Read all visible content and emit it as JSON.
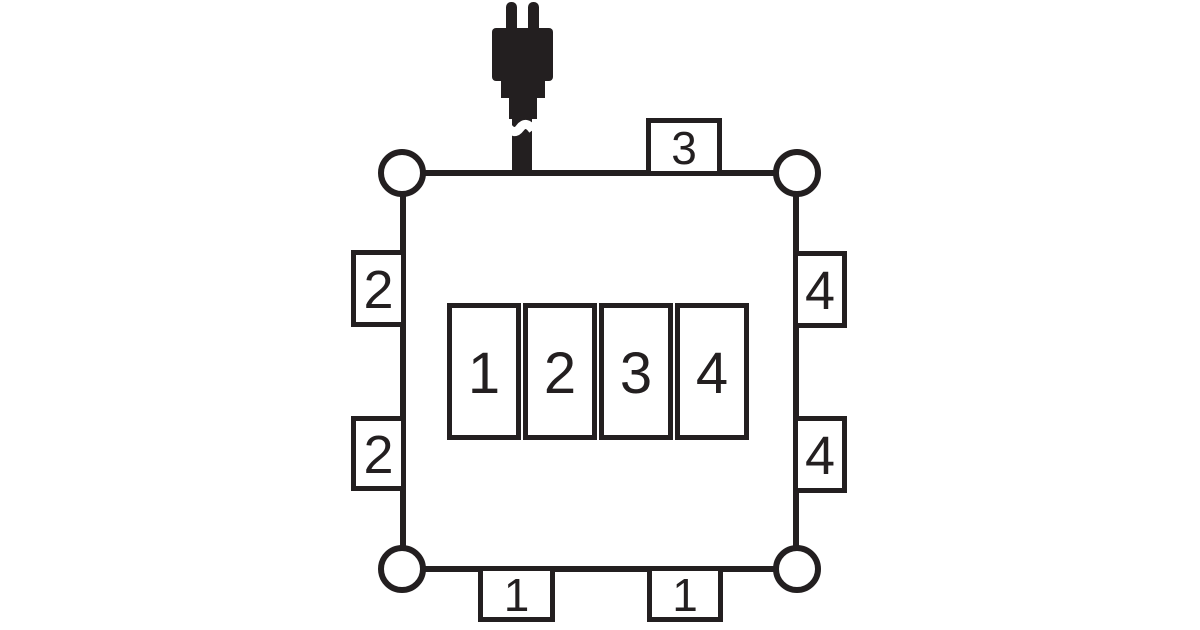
{
  "colors": {
    "line": "#231f20",
    "background": "#ffffff"
  },
  "icons": {
    "plug": "power-plug-icon",
    "corner": "corner-circle"
  },
  "port_labels": {
    "top": "3",
    "left_upper": "2",
    "left_lower": "2",
    "right_upper": "4",
    "right_lower": "4",
    "bottom_left": "1",
    "bottom_right": "1"
  },
  "socket_cells": [
    "1",
    "2",
    "3",
    "4"
  ]
}
